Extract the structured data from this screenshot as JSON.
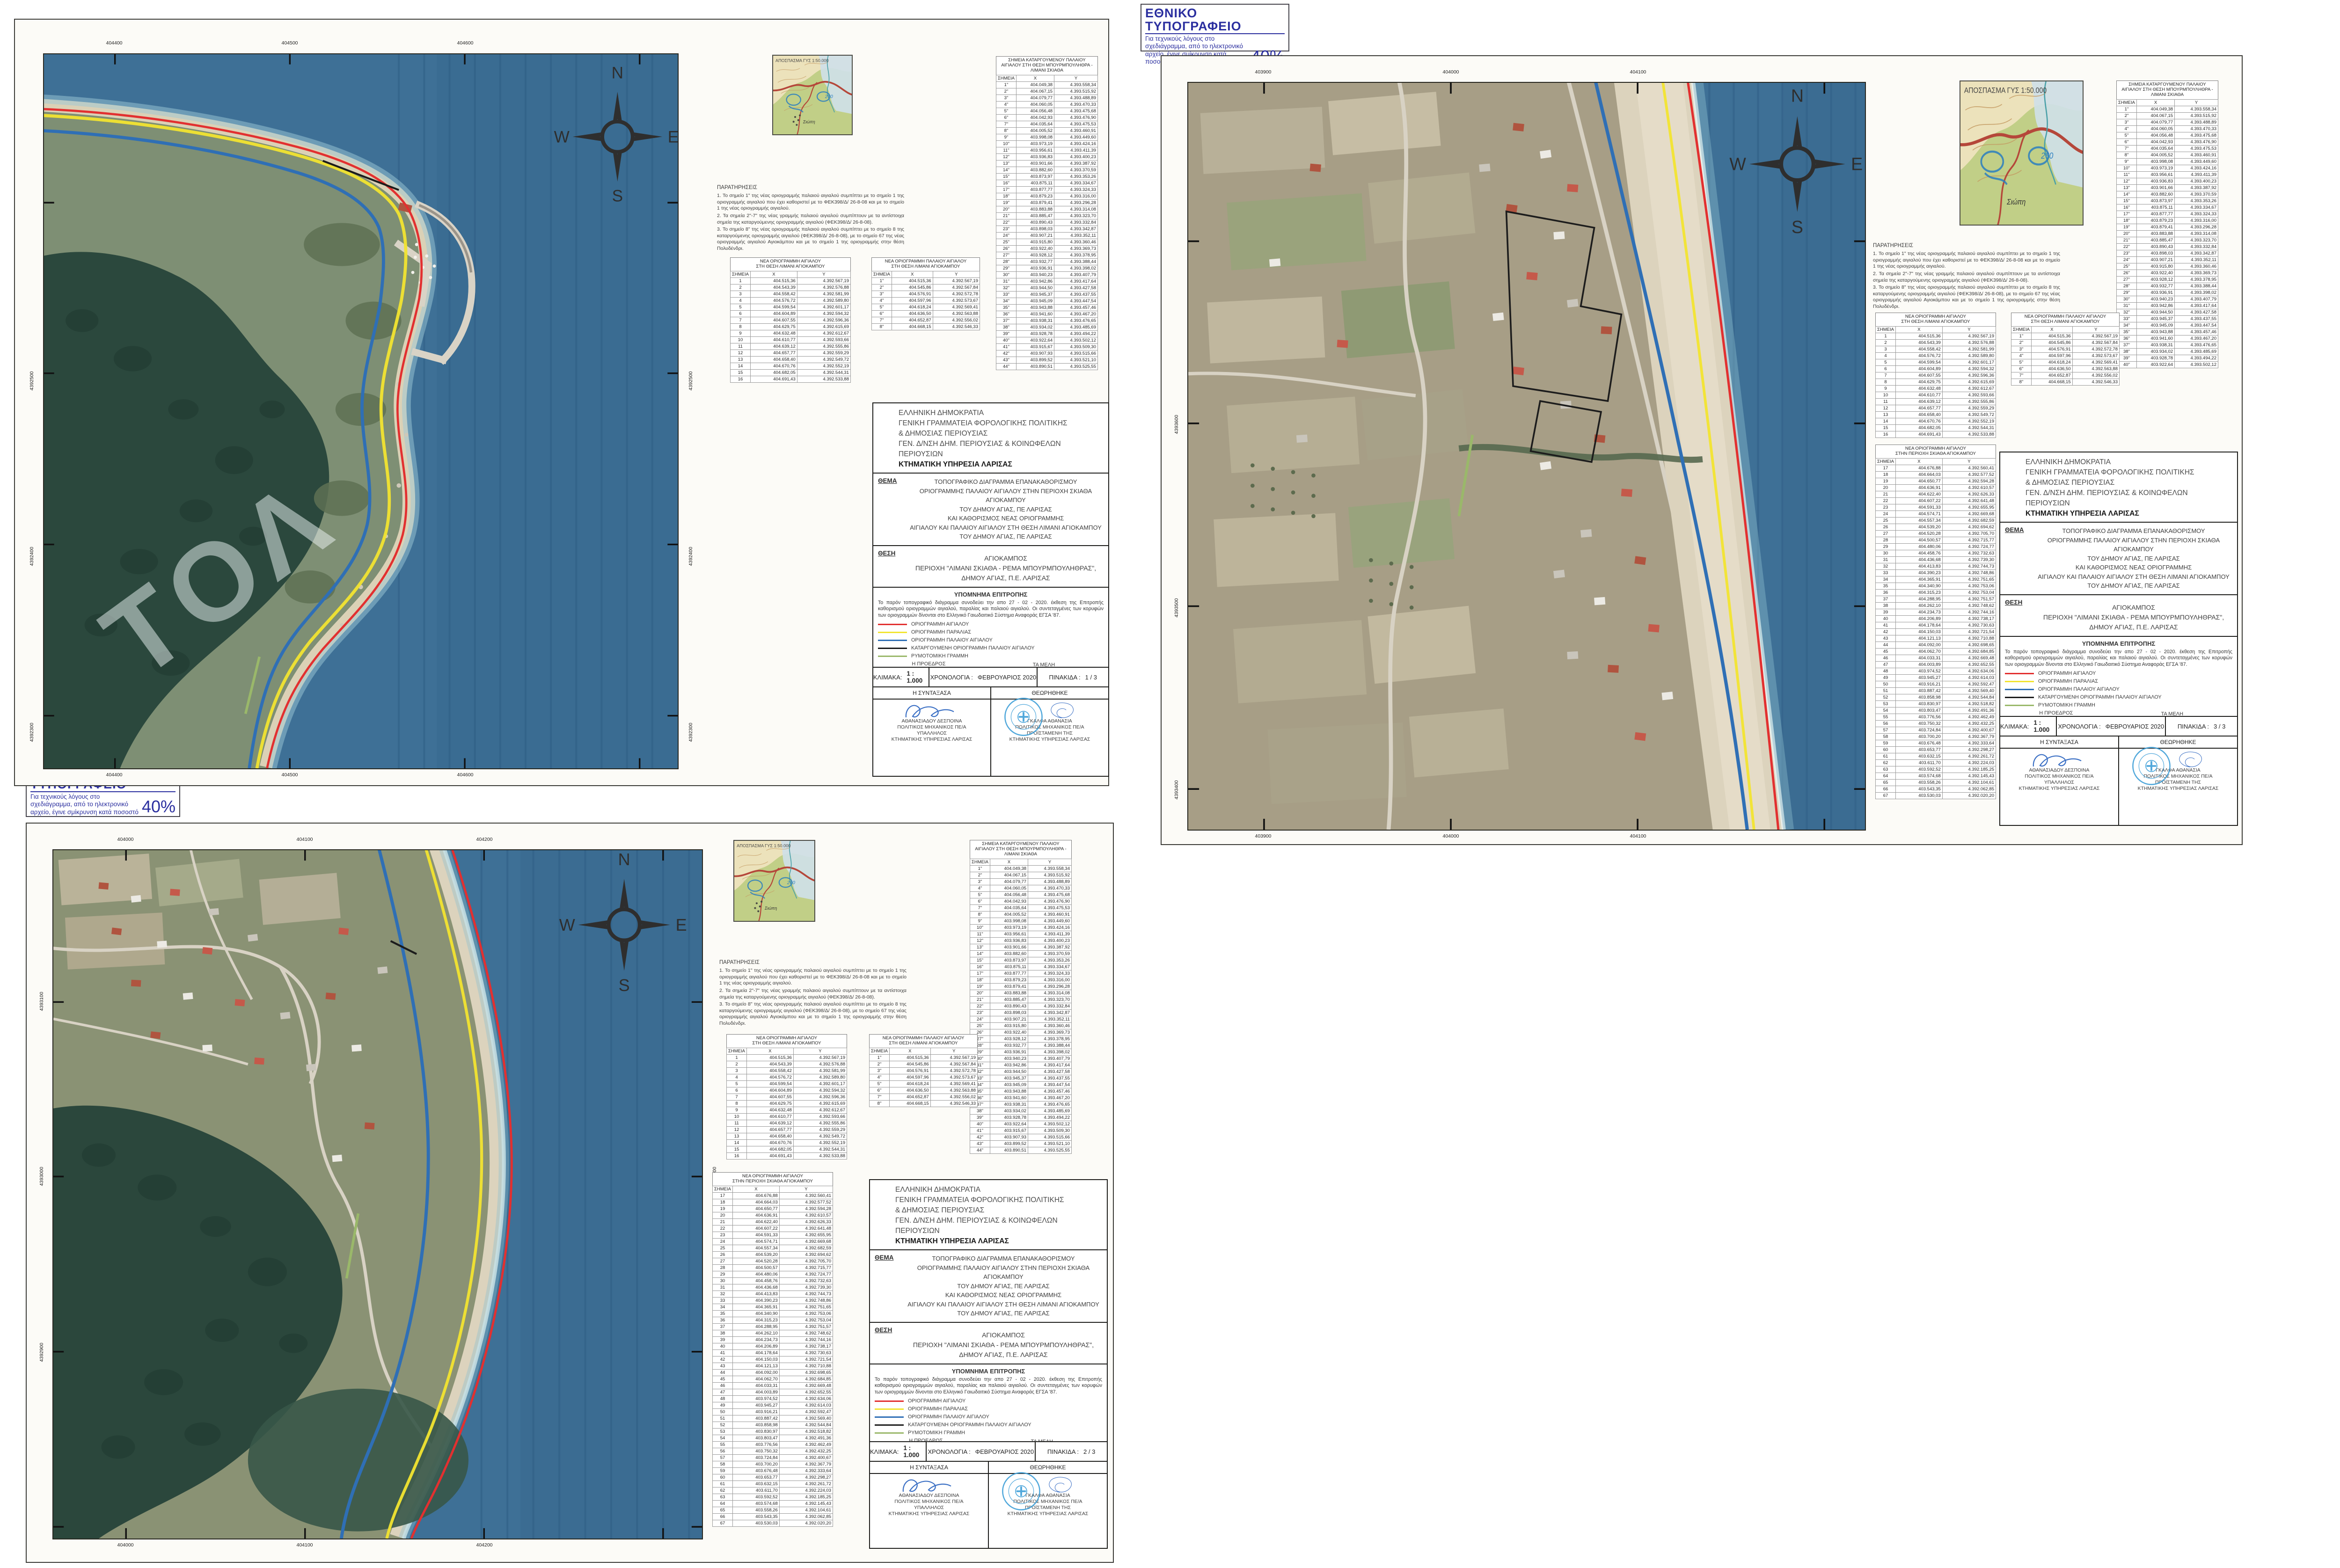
{
  "common": {
    "stamp": {
      "title": "ΕΘΝΙΚΟ ΤΥΠΟΓΡΑΦΕΙΟ",
      "body": "Για τεχνικούς λόγους στο σχεδιάγραμμα, από το ηλεκτρονικό αρχείο, έγινε σμίκρυνση κατά ποσοστό",
      "percent": "40%"
    },
    "compass": {
      "n": "N",
      "e": "E",
      "s": "S",
      "w": "W"
    },
    "locator_caption": "ΑΠΟΣΠΑΣΜΑ ΓΥΣ 1:50.000",
    "locator_place": "Σιώπη",
    "locator_note": "260",
    "agency": [
      "ΕΛΛΗΝΙΚΗ ΔΗΜΟΚΡΑΤΙΑ",
      "ΓΕΝΙΚΗ ΓΡΑΜΜΑΤΕΙΑ ΦΟΡΟΛΟΓΙΚΗΣ ΠΟΛΙΤΙΚΗΣ",
      "& ΔΗΜΟΣΙΑΣ ΠΕΡΙΟΥΣΙΑΣ",
      "ΓΕΝ. Δ/ΝΣΗ ΔΗΜ. ΠΕΡΙΟΥΣΙΑΣ & ΚΟΙΝΩΦΕΛΩΝ ΠΕΡΙΟΥΣΙΩΝ",
      "ΚΤΗΜΑΤΙΚΗ ΥΠΗΡΕΣΙΑ ΛΑΡΙΣΑΣ"
    ],
    "thema_label": "ΘΕΜΑ",
    "thema": [
      "ΤΟΠΟΓΡΑΦΙΚΟ ΔΙΑΓΡΑΜΜΑ ΕΠΑΝΑΚΑΘΟΡΙΣΜΟΥ",
      "ΟΡΙΟΓΡΑΜΜΗΣ ΠΑΛΑΙΟΥ ΑΙΓΙΑΛΟΥ ΣΤΗΝ ΠΕΡΙΟΧΗ ΣΚΙΑΘΑ ΑΓΙΟΚΑΜΠΟΥ",
      "ΤΟΥ ΔΗΜΟΥ ΑΓΙΑΣ, ΠΕ ΛΑΡΙΣΑΣ",
      "ΚΑΙ ΚΑΘΟΡΙΣΜΟΣ ΝΕΑΣ ΟΡΙΟΓΡΑΜΜΗΣ",
      "ΑΙΓΙΑΛΟΥ ΚΑΙ ΠΑΛΑΙΟΥ ΑΙΓΙΑΛΟΥ ΣΤΗ ΘΕΣΗ ΛΙΜΑΝΙ ΑΓΙΟΚΑΜΠΟΥ",
      "ΤΟΥ ΔΗΜΟΥ ΑΓΙΑΣ, ΠΕ ΛΑΡΙΣΑΣ"
    ],
    "thesi_label": "ΘΕΣΗ",
    "thesi": [
      "ΑΓΙΟΚΑΜΠΟΣ",
      "ΠΕΡΙΟΧΗ \"ΛΙΜΑΝΙ ΣΚΙΑΘΑ - ΡΕΜΑ ΜΠΟΥΡΜΠΟΥΛΗΘΡΑΣ\",",
      "ΔΗΜΟΥ ΑΓΙΑΣ, Π.Ε. ΛΑΡΙΣΑΣ"
    ],
    "ypomnima_title": "ΥΠΟΜΝΗΜΑ ΕΠΙΤΡΟΠΗΣ",
    "ypomnima_text": "Το παρόν τοπογραφικό διάγραμμα συνοδεύει την απο  27 - 02 - 2020.  έκθεση της Επιτροπής καθορισμού οριογραμμών αιγιαλού, παραλίας και παλαιού αιγιαλού. Οι συντεταγμένες των κορυφών των οριογραμμών δίνονται στο Ελληνικό Γαιωδαιτικό Σύστημα Αναφοράς ΕΓΣΑ '87.",
    "legend": [
      {
        "color": "#e23030",
        "label": "ΟΡΙΟΓΡΑΜΜΗ ΑΙΓΙΑΛΟΥ"
      },
      {
        "color": "#f2e430",
        "label": "ΟΡΙΟΓΡΑΜΜΗ ΠΑΡΑΛΙΑΣ"
      },
      {
        "color": "#2f6fb5",
        "label": "ΟΡΙΟΓΡΑΜΜΗ ΠΑΛΑΙΟΥ ΑΙΓΙΑΛΟΥ"
      },
      {
        "color": "#1c1c1c",
        "label": "ΚΑΤΑΡΓΟΥΜΕΝΗ ΟΡΙΟΓΡΑΜΜΗ ΠΑΛΑΙΟΥ ΑΙΓΙΑΛΟΥ"
      },
      {
        "color": "#9ab86a",
        "label": "ΡΥΜΟΤΟΜΙΚΗ ΓΡΑΜΜΗ"
      }
    ],
    "committee": {
      "president_label": "Η ΠΡΟΕΔΡΟΣ",
      "members_label": "ΤΑ ΜΕΛΗ",
      "president": {
        "num": "1.",
        "name": "ΓΚΑΛΦΑ ΑΘΑΝΑΣΙΑ",
        "roles": [
          "ΠΟΛΙΤΙΚΟΣ ΜΗΧΑΝΙΚΟΣ ΠΕ/Α",
          "ΠΡΟΪΣΤΑΜΕΝΗ  ΤΗΣ",
          "ΚΤΗΜΑΤΙΚΗΣ ΥΠΗΡΕΣΙΑΣ",
          "ΛΑΡΙΣΑΣ"
        ]
      },
      "members": [
        {
          "num": "2.",
          "name": "ΚΩΝΣΤΑΝΤΑ ΒΑΣΙΛΙΚΗ"
        },
        {
          "num": "3.",
          "name": "ΑΘΑΝΑΣΙΑΔΟΥ ΔΕΣΠΟΙΝΑ"
        },
        {
          "num": "4.",
          "name": "ΓΡΗΓΟΡΟΥΛΗΣ ΓΕΩΡΓΙΟΣ"
        },
        {
          "num": "5.",
          "name": "ΠΑΠΑΔΗΜΗΤΡΙΟΥ ΚΩΝ/ΝΟΣ"
        }
      ]
    },
    "footer": {
      "scale_label": "ΚΛΙΜΑΚΑ:",
      "scale_value": "1 : 1.000",
      "date_label": "ΧΡΟΝΟΛΟΓΙΑ :",
      "date_value": "ΦΕΒΡΟΥΑΡΙΟΣ 2020",
      "plate_label": "ΠΙΝΑΚΙΔΑ :",
      "author_header": "Η ΣΥΝΤΑΞΑΣΑ",
      "approved_header": "ΘΕΩΡΗΘΗΚΕ",
      "author": [
        "ΑΘΑΝΑΣΙΑΔΟΥ ΔΕΣΠΟΙΝΑ",
        "ΠΟΛΙΤΙΚΟΣ ΜΗΧΑΝΙΚΟΣ ΠΕ/Α",
        "ΥΠΑΛΛΗΛΟΣ",
        "ΚΤΗΜΑΤΙΚΗΣ ΥΠΗΡΕΣΙΑΣ ΛΑΡΙΣΑΣ"
      ],
      "approver": [
        "ΓΚΑΛΦΑ ΑΘΑΝΑΣΙΑ",
        "ΠΟΛΙΤΙΚΟΣ ΜΗΧΑΝΙΚΟΣ ΠΕ/Α",
        "ΠΡΟΪΣΤΑΜΕΝΗ  ΤΗΣ",
        "ΚΤΗΜΑΤΙΚΗΣ ΥΠΗΡΕΣΙΑΣ ΛΑΡΙΣΑΣ"
      ]
    },
    "notes": {
      "title": "ΠΑΡΑΤΗΡΗΣΕΙΣ",
      "items": [
        "1. Το σημείο 1\" της νέας οριογραμμής παλαιού αιγιαλού συμπίπτει με το σημείο 1 της οριογραμμής αιγιαλού που έχει καθοριστεί με το ΦΕΚ398/Δ/ 26-8-08  και με το σημείο 1 της νέας οριογραμμής αιγιαλού.",
        "2. Τα σημεία 2\"-7\" της νέας γραμμής παλαιού αιγιαλού συμπίπτουν με τα αντίστοιχα σημεία της καταργούμενης οριογραμμής αιγιαλού (ΦΕΚ398/Δ/ 26-8-08).",
        "3. Το σημείο 8\" της νέας οριογραμμής παλαιού αιγιαλού συμπίπτει με το σημείο 8 της καταργούμενης οριογραμμής αιγιαλού (ΦΕΚ398/Δ/ 26-8-08), με το σημείο 67 της νέας οριογραμμής αιγιαλού Αγιοκάμπου και με το σημείο 1 της οριογραμμής στην θέση Πολυδένδρι."
      ]
    }
  },
  "sheets": [
    {
      "pinakida": "1  / 3",
      "map": {
        "x_labels": [
          "404400",
          "404500",
          "404600"
        ],
        "y_labels": [
          "4392500",
          "4392400",
          "4392300"
        ],
        "watermark": "ΤΟΛ"
      }
    },
    {
      "pinakida": "3  / 3",
      "map": {
        "x_labels": [
          "403900",
          "404000",
          "404100"
        ],
        "y_labels": [
          "4393600",
          "4393500",
          "4393400"
        ],
        "watermark": ""
      }
    },
    {
      "pinakida": "2  / 3",
      "map": {
        "x_labels": [
          "404000",
          "404100",
          "404200"
        ],
        "y_labels": [
          "4393100",
          "4393000",
          "4392900"
        ],
        "watermark": ""
      }
    }
  ],
  "tables": {
    "a": {
      "title": [
        "ΝΕΑ ΟΡΙΟΓΡΑΜΜΗ ΑΙΓΙΑΛΟΥ",
        "ΣΤΗ ΘΕΣΗ ΛΙΜΑΝΙ ΑΓΙΟΚΑΜΠΟΥ"
      ],
      "cols": [
        "ΣΗΜΕΙΑ",
        "X",
        "Y"
      ],
      "rows": [
        [
          "1",
          "404.515,36",
          "4.392.567,19"
        ],
        [
          "2",
          "404.543,39",
          "4.392.576,88"
        ],
        [
          "3",
          "404.558,42",
          "4.392.581,99"
        ],
        [
          "4",
          "404.576,72",
          "4.392.589,80"
        ],
        [
          "5",
          "404.599,54",
          "4.392.601,17"
        ],
        [
          "6",
          "404.604,89",
          "4.392.594,32"
        ],
        [
          "7",
          "404.607,55",
          "4.392.596,36"
        ],
        [
          "8",
          "404.629,75",
          "4.392.615,69"
        ],
        [
          "9",
          "404.632,48",
          "4.392.612,67"
        ],
        [
          "10",
          "404.610,77",
          "4.392.593,66"
        ],
        [
          "11",
          "404.639,12",
          "4.392.555,86"
        ],
        [
          "12",
          "404.657,77",
          "4.392.559,29"
        ],
        [
          "13",
          "404.658,40",
          "4.392.549,72"
        ],
        [
          "14",
          "404.670,76",
          "4.392.552,19"
        ],
        [
          "15",
          "404.682,05",
          "4.392.544,31"
        ],
        [
          "16",
          "404.691,43",
          "4.392.533,88"
        ]
      ]
    },
    "b": {
      "title": [
        "ΝΕΑ ΟΡΙΟΓΡΑΜΜΗ ΠΑΛΑΙΟΥ ΑΙΓΙΑΛΟΥ",
        "ΣΤΗ ΘΕΣΗ ΛΙΜΑΝΙ ΑΓΙΟΚΑΜΠΟΥ"
      ],
      "cols": [
        "ΣΗΜΕΙΑ",
        "X",
        "Y"
      ],
      "rows": [
        [
          "1\"",
          "404.515,36",
          "4.392.567,19"
        ],
        [
          "2\"",
          "404.545,86",
          "4.392.567,84"
        ],
        [
          "3\"",
          "404.576,91",
          "4.392.572,78"
        ],
        [
          "4\"",
          "404.597,96",
          "4.392.573,67"
        ],
        [
          "5\"",
          "404.618,24",
          "4.392.569,41"
        ],
        [
          "6\"",
          "404.636,50",
          "4.392.563,88"
        ],
        [
          "7\"",
          "404.652,87",
          "4.392.556,02"
        ],
        [
          "8\"",
          "404.668,15",
          "4.392.546,33"
        ]
      ]
    },
    "c": {
      "title": [
        "ΣΗΜΕΙΑ ΚΑΤΑΡΓΟΥΜΕΝΟΥ ΠΑΛΑΙΟΥ",
        "ΑΙΓΙΑΛΟΥ ΣΤΗ ΘΕΣΗ ΜΠΟΥΡΜΠΟΥΛΗΘΡΑ -",
        "ΛΙΜΑΝΙ ΣΚΙΑΘΑ"
      ],
      "cols": [
        "ΣΗΜΕΙΑ",
        "X",
        "Y"
      ],
      "rows": [
        [
          "1\"",
          "404.049,38",
          "4.393.558,34"
        ],
        [
          "2\"",
          "404.067,15",
          "4.393.515,92"
        ],
        [
          "3\"",
          "404.079,77",
          "4.393.488,89"
        ],
        [
          "4\"",
          "404.060,05",
          "4.393.470,33"
        ],
        [
          "5\"",
          "404.056,48",
          "4.393.475,68"
        ],
        [
          "6\"",
          "404.042,93",
          "4.393.476,90"
        ],
        [
          "7\"",
          "404.035,64",
          "4.393.475,53"
        ],
        [
          "8\"",
          "404.005,52",
          "4.393.460,91"
        ],
        [
          "9\"",
          "403.998,08",
          "4.393.449,60"
        ],
        [
          "10\"",
          "403.973,19",
          "4.393.424,16"
        ],
        [
          "11\"",
          "403.956,61",
          "4.393.411,39"
        ],
        [
          "12\"",
          "403.936,83",
          "4.393.400,23"
        ],
        [
          "13\"",
          "403.901,66",
          "4.393.387,92"
        ],
        [
          "14\"",
          "403.882,60",
          "4.393.370,59"
        ],
        [
          "15\"",
          "403.873,97",
          "4.393.353,26"
        ],
        [
          "16\"",
          "403.875,11",
          "4.393.334,67"
        ],
        [
          "17\"",
          "403.877,77",
          "4.393.324,33"
        ],
        [
          "18\"",
          "403.879,23",
          "4.393.316,00"
        ],
        [
          "19\"",
          "403.879,41",
          "4.393.296,28"
        ],
        [
          "20\"",
          "403.883,88",
          "4.393.314,08"
        ],
        [
          "21\"",
          "403.885,47",
          "4.393.323,70"
        ],
        [
          "22\"",
          "403.890,43",
          "4.393.332,84"
        ],
        [
          "23\"",
          "403.898,03",
          "4.393.342,87"
        ],
        [
          "24\"",
          "403.907,21",
          "4.393.352,11"
        ],
        [
          "25\"",
          "403.915,80",
          "4.393.360,46"
        ],
        [
          "26\"",
          "403.922,40",
          "4.393.369,73"
        ],
        [
          "27\"",
          "403.928,12",
          "4.393.378,95"
        ],
        [
          "28\"",
          "403.932,77",
          "4.393.388,44"
        ],
        [
          "29\"",
          "403.936,91",
          "4.393.398,02"
        ],
        [
          "30\"",
          "403.940,23",
          "4.393.407,79"
        ],
        [
          "31\"",
          "403.942,86",
          "4.393.417,64"
        ],
        [
          "32\"",
          "403.944,50",
          "4.393.427,58"
        ],
        [
          "33\"",
          "403.945,37",
          "4.393.437,55"
        ],
        [
          "34\"",
          "403.945,09",
          "4.393.447,54"
        ],
        [
          "35\"",
          "403.943,88",
          "4.393.457,46"
        ],
        [
          "36\"",
          "403.941,60",
          "4.393.467,20"
        ],
        [
          "37\"",
          "403.938,31",
          "4.393.476,65"
        ],
        [
          "38\"",
          "403.934,02",
          "4.393.485,69"
        ],
        [
          "39\"",
          "403.928,78",
          "4.393.494,22"
        ],
        [
          "40\"",
          "403.922,64",
          "4.393.502,12"
        ],
        [
          "41\"",
          "403.915,67",
          "4.393.509,30"
        ],
        [
          "42\"",
          "403.907,93",
          "4.393.515,66"
        ],
        [
          "43\"",
          "403.899,52",
          "4.393.521,10"
        ],
        [
          "44\"",
          "403.890,51",
          "4.393.525,55"
        ]
      ]
    },
    "a2": {
      "title": [
        "ΝΕΑ ΟΡΙΟΓΡΑΜΜΗ ΑΙΓΙΑΛΟΥ",
        "ΣΤΗΝ ΠΕΡΙΟΧΗ ΣΚΙΑΘΑ ΑΓΙΟΚΑΜΠΟΥ"
      ],
      "cols": [
        "ΣΗΜΕΙΑ",
        "X",
        "Y"
      ],
      "rows": [
        [
          "17",
          "404.676,88",
          "4.392.560,41"
        ],
        [
          "18",
          "404.664,03",
          "4.392.577,52"
        ],
        [
          "19",
          "404.650,77",
          "4.392.594,28"
        ],
        [
          "20",
          "404.636,91",
          "4.392.610,57"
        ],
        [
          "21",
          "404.622,40",
          "4.392.626,33"
        ],
        [
          "22",
          "404.607,22",
          "4.392.641,48"
        ],
        [
          "23",
          "404.591,33",
          "4.392.655,95"
        ],
        [
          "24",
          "404.574,71",
          "4.392.669,68"
        ],
        [
          "25",
          "404.557,34",
          "4.392.682,59"
        ],
        [
          "26",
          "404.539,20",
          "4.392.694,62"
        ],
        [
          "27",
          "404.520,28",
          "4.392.705,70"
        ],
        [
          "28",
          "404.500,57",
          "4.392.715,77"
        ],
        [
          "29",
          "404.480,06",
          "4.392.724,77"
        ],
        [
          "30",
          "404.458,76",
          "4.392.732,63"
        ],
        [
          "31",
          "404.436,68",
          "4.392.739,30"
        ],
        [
          "32",
          "404.413,83",
          "4.392.744,73"
        ],
        [
          "33",
          "404.390,23",
          "4.392.748,86"
        ],
        [
          "34",
          "404.365,91",
          "4.392.751,65"
        ],
        [
          "35",
          "404.340,90",
          "4.392.753,06"
        ],
        [
          "36",
          "404.315,23",
          "4.392.753,04"
        ],
        [
          "37",
          "404.288,95",
          "4.392.751,57"
        ],
        [
          "38",
          "404.262,10",
          "4.392.748,62"
        ],
        [
          "39",
          "404.234,73",
          "4.392.744,16"
        ],
        [
          "40",
          "404.206,89",
          "4.392.738,17"
        ],
        [
          "41",
          "404.178,64",
          "4.392.730,63"
        ],
        [
          "42",
          "404.150,03",
          "4.392.721,54"
        ],
        [
          "43",
          "404.121,13",
          "4.392.710,88"
        ],
        [
          "44",
          "404.092,00",
          "4.392.698,65"
        ],
        [
          "45",
          "404.062,70",
          "4.392.684,85"
        ],
        [
          "46",
          "404.033,31",
          "4.392.669,48"
        ],
        [
          "47",
          "404.003,89",
          "4.392.652,55"
        ],
        [
          "48",
          "403.974,52",
          "4.392.634,06"
        ],
        [
          "49",
          "403.945,27",
          "4.392.614,03"
        ],
        [
          "50",
          "403.916,21",
          "4.392.592,47"
        ],
        [
          "51",
          "403.887,42",
          "4.392.569,40"
        ],
        [
          "52",
          "403.858,98",
          "4.392.544,84"
        ],
        [
          "53",
          "403.830,97",
          "4.392.518,82"
        ],
        [
          "54",
          "403.803,47",
          "4.392.491,36"
        ],
        [
          "55",
          "403.776,56",
          "4.392.462,49"
        ],
        [
          "56",
          "403.750,32",
          "4.392.432,25"
        ],
        [
          "57",
          "403.724,84",
          "4.392.400,67"
        ],
        [
          "58",
          "403.700,20",
          "4.392.367,79"
        ],
        [
          "59",
          "403.676,48",
          "4.392.333,64"
        ],
        [
          "60",
          "403.653,77",
          "4.392.298,27"
        ],
        [
          "61",
          "403.632,15",
          "4.392.261,72"
        ],
        [
          "62",
          "403.611,70",
          "4.392.224,03"
        ],
        [
          "63",
          "403.592,52",
          "4.392.185,25"
        ],
        [
          "64",
          "403.574,68",
          "4.392.145,43"
        ],
        [
          "65",
          "403.558,26",
          "4.392.104,61"
        ],
        [
          "66",
          "403.543,35",
          "4.392.062,85"
        ],
        [
          "67",
          "403.530,03",
          "4.392.020,20"
        ]
      ]
    }
  }
}
